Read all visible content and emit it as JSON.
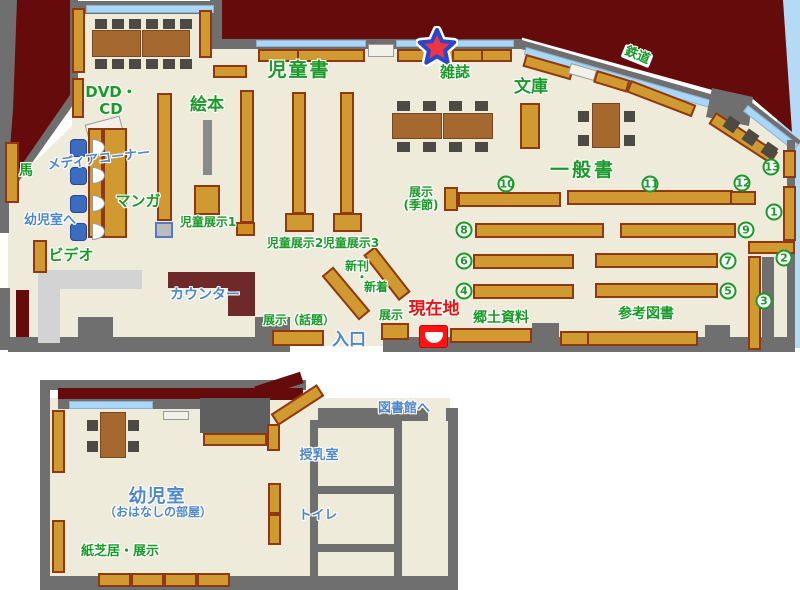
{
  "colors": {
    "exterior_wall": "#660b0b",
    "interior_floor": "#eeebdb",
    "wall_gray": "#6f6f6f",
    "window_blue": "#a9d7f7",
    "outside_blue": "#b5daf5",
    "shelf_orange": "#d19a31",
    "shelf_border": "#8f3812",
    "table_brown": "#a5682e",
    "counter_maroon": "#6e2a28",
    "label_green": "#1a9a28",
    "label_blue": "#4f87cb",
    "label_red": "#ee1111"
  },
  "main_floor": {
    "labels": {
      "dvd_cd_line1": "DVD・",
      "dvd_cd_line2": "CD",
      "ehon": "絵本",
      "jidousho": "児童書",
      "zasshi": "雑誌",
      "bunko": "文庫",
      "tetsudou": "鉄道",
      "ippansho": "一般書",
      "tenji_kisetsu_line1": "展示",
      "tenji_kisetsu_line2": "(季節)",
      "media_corner": "メディアコーナー",
      "manga": "マンガ",
      "uma": "馬",
      "youjishitsu_he": "幼児室へ",
      "video": "ビデオ",
      "jidou_tenji1": "児童展示1",
      "jidou_tenji2": "児童展示2",
      "jidou_tenji3": "児童展示3",
      "shinkan": "新刊",
      "nakaguro": "・",
      "shinchaku": "新着",
      "counter": "カウンター",
      "tenji_wadai": "展示（話題）",
      "tenji": "展示",
      "genzaichi": "現在地",
      "iriguchi": "入口",
      "kyoudo_shiryou": "郷土資料",
      "sankou_tosho": "参考図書"
    },
    "shelf_numbers": {
      "n1": "1",
      "n2": "2",
      "n3": "3",
      "n4": "4",
      "n5": "5",
      "n6": "6",
      "n7": "7",
      "n8": "8",
      "n9": "9",
      "n10": "10",
      "n11": "11",
      "n12": "12",
      "n13": "13"
    }
  },
  "annex": {
    "labels": {
      "youjishitsu": "幼児室",
      "ohanashi_no_heya": "（おはなしの部屋）",
      "kamishibai_tenji": "紙芝居・展示",
      "junyuushitsu": "授乳室",
      "toire": "トイレ",
      "toshokan_he": "図書館へ"
    }
  }
}
